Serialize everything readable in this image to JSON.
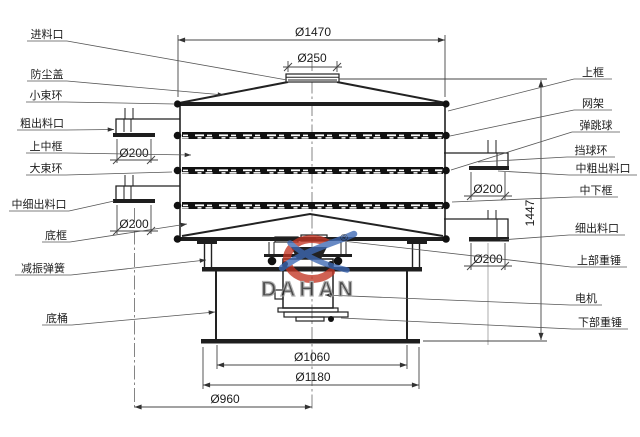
{
  "labels": {
    "left": [
      "进料口",
      "防尘盖",
      "小束环",
      "粗出料口",
      "上中框",
      "大束环",
      "中细出料口",
      "底框",
      "减振弹簧",
      "底桶"
    ],
    "right": [
      "上框",
      "网架",
      "弹跳球",
      "挡球环",
      "中粗出料口",
      "中下框",
      "细出料口",
      "上部重锤",
      "电机",
      "下部重锤"
    ]
  },
  "dims": {
    "flange": "Ø1470",
    "inlet": "Ø250",
    "outlet": "Ø200",
    "height": "1447",
    "base_top": "Ø1060",
    "base_bottom": "Ø1180",
    "outlet_circle": "Ø960"
  },
  "watermark": {
    "brand": "DAHAN",
    "registered": "®"
  },
  "colors": {
    "line": "#222222",
    "brand_red": "#c23524",
    "brand_blue": "#3d69b4",
    "watermark_text": "#9a9a9a"
  }
}
